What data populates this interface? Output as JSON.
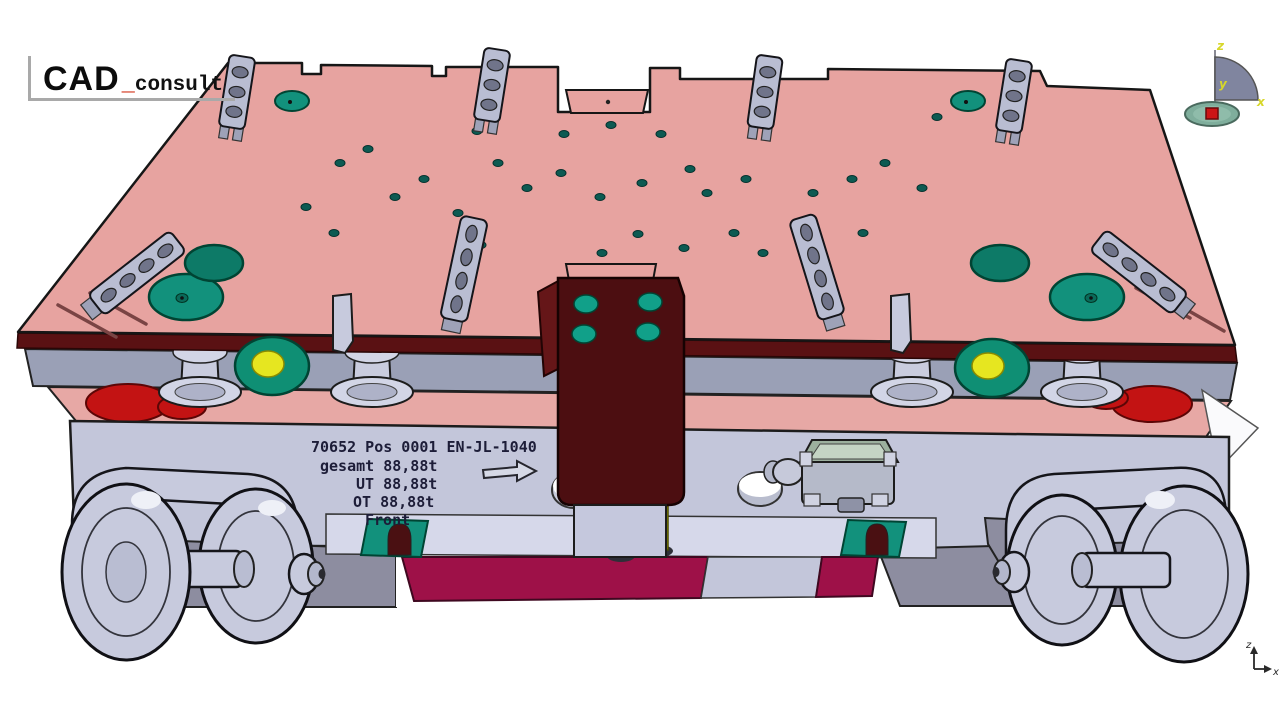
{
  "logo": {
    "brand": "CAD",
    "underscore": "_",
    "suffix": "consult"
  },
  "die_label": {
    "line1": "70652 Pos 0001 EN-JL-1040",
    "line2": "gesamt 88,88t",
    "line3": "UT 88,88t",
    "line4": "OT 88,88t",
    "line5": "Front"
  },
  "compass": {
    "z": "z",
    "y": "y",
    "x": "x"
  },
  "axis_triad": {
    "z": "z",
    "x": "x"
  },
  "colors": {
    "plate_salmon": "#e7a3a0",
    "front_edge_maroon": "#5a1113",
    "bracket_maroon": "#4c0e11",
    "pocket_teal": "#12917c",
    "band_gray": "#9aa0b6",
    "body_lavender": "#c3c6da",
    "wheel_gray": "#c7cadd",
    "crimson_strip": "#9e1148",
    "pin_yellow": "#c6c600",
    "spring_red": "#c31313",
    "compass_base_green": "#7fae9c",
    "compass_square_red": "#cc1515"
  }
}
